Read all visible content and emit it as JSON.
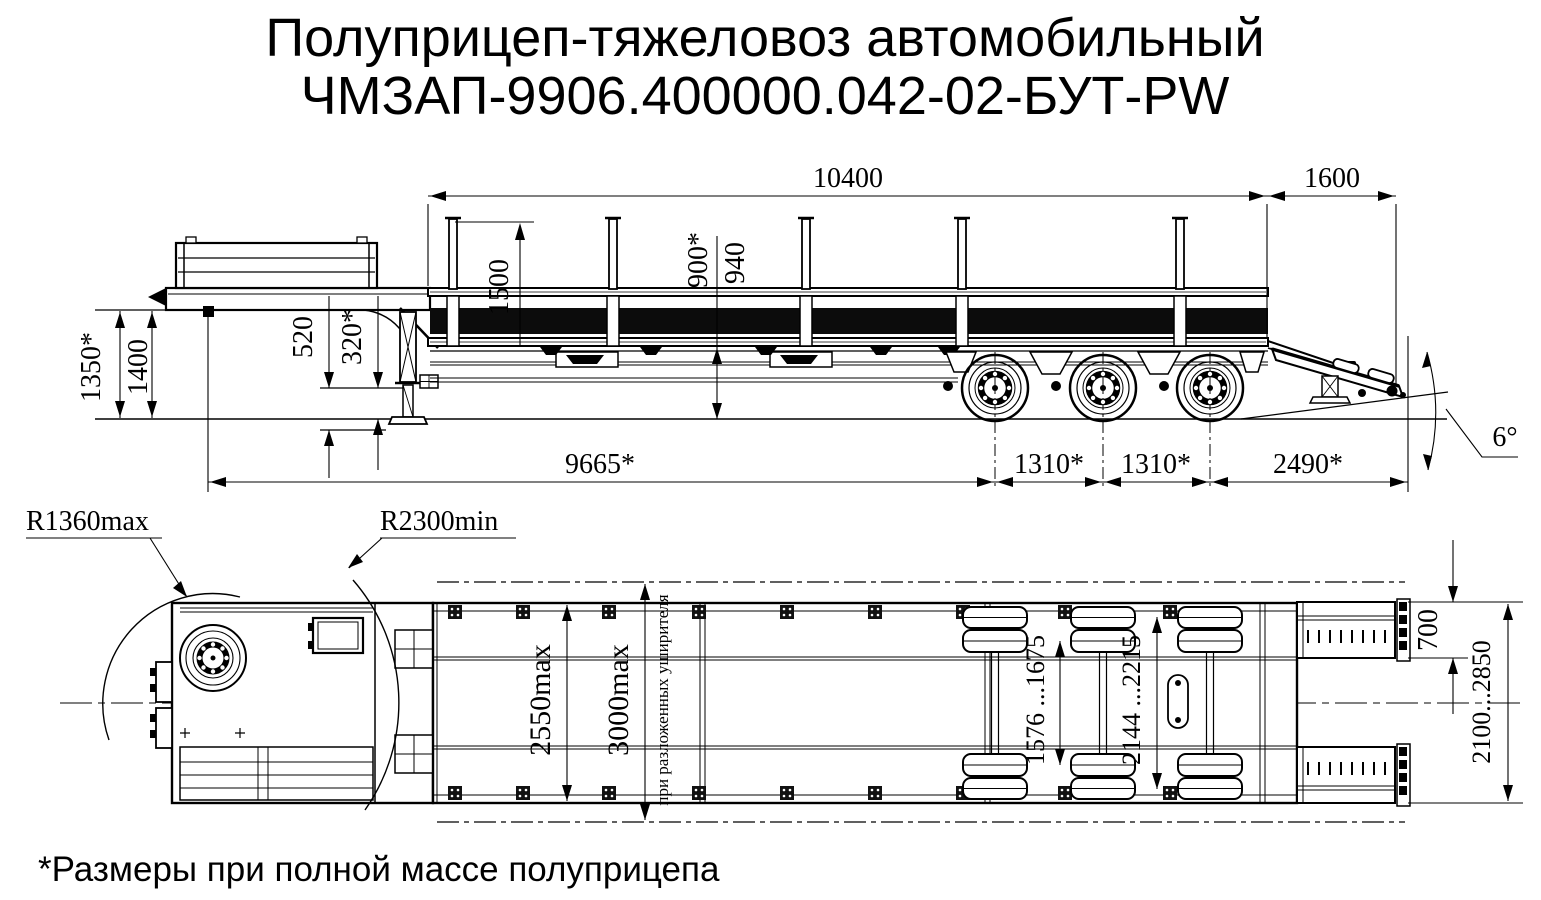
{
  "title": {
    "line1": "Полуприцеп-тяжеловоз автомобильный",
    "line2": "ЧМЗАП-9906.400000.042-02-БУТ-PW"
  },
  "footnote": "*Размеры при полной массе полуприцепа",
  "colors": {
    "ink": "#000000",
    "paper": "#ffffff"
  },
  "side_view": {
    "dims": {
      "length_top": "10400",
      "rear_top": "1600",
      "stake_height": "1500",
      "loading_height_laden": "900*",
      "loading_height": "940",
      "front_height_laden": "1350*",
      "front_height": "1400",
      "neck_clearance": "520",
      "ground_clearance": "320*",
      "base": "9665*",
      "axle_spacing_1": "1310*",
      "axle_spacing_2": "1310*",
      "rear_length": "2490*",
      "ramp_angle": "6°"
    }
  },
  "top_view": {
    "dims": {
      "swing_radius_max": "R1360max",
      "swing_radius_min": "R2300min",
      "width_max": "2550max",
      "width_widened": "3000max",
      "widener_note": "при разложенных уширителя",
      "track_inner": "1576 ...1675",
      "track_outer": "2144 ...2215",
      "ramp_width": "700",
      "ramp_track": "2100...2850"
    }
  }
}
